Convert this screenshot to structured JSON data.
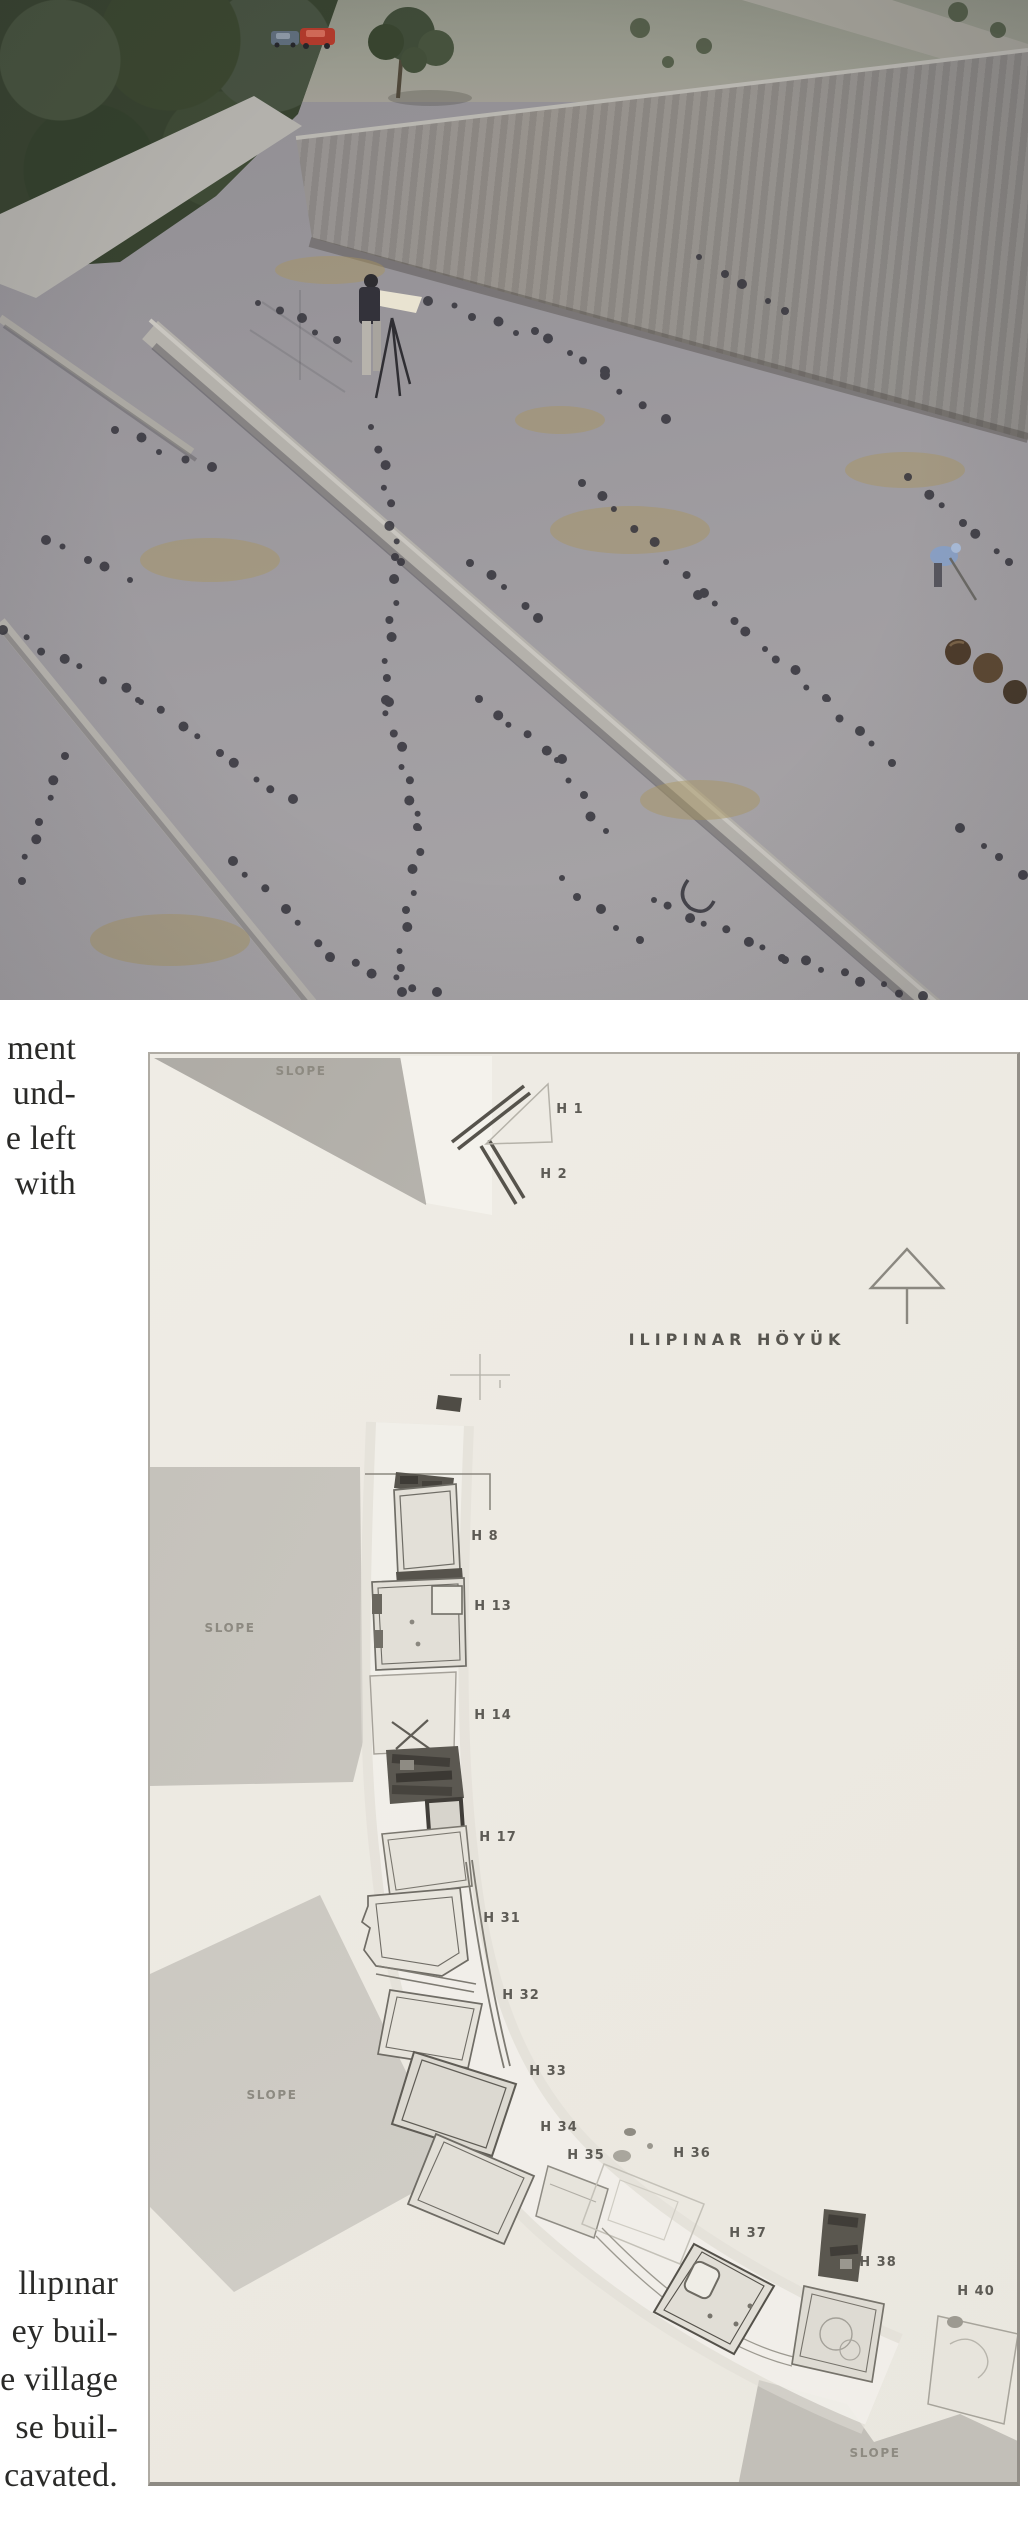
{
  "page": {
    "width": 1028,
    "height": 2546,
    "background": "#ffffff"
  },
  "captions": {
    "top_fragment_lines": [
      "ment",
      "und-",
      "e left",
      "with"
    ],
    "bottom_fragment_lines": [
      "llıpınar",
      "ey buil-",
      "e village",
      "se buil-",
      "cavated."
    ]
  },
  "photo": {
    "alt": "Excavation at Ilıpınar: surveyor with plane table on excavated surface marked by rows of dark postholes; earthen section wall, dirt road and trees above, parked cars, worker in blue, pottery vessels at right"
  },
  "plan": {
    "site_title": "ILIPINAR HÖYÜK",
    "slope_labels": [
      {
        "text": "SLOPE",
        "cx": 151,
        "cy": 18
      },
      {
        "text": "SLOPE",
        "cx": 80,
        "cy": 575
      },
      {
        "text": "SLOPE",
        "cx": 122,
        "cy": 1042
      },
      {
        "text": "SLOPE",
        "cx": 725,
        "cy": 1400
      }
    ],
    "house_labels": [
      {
        "text": "H 1",
        "cx": 420,
        "cy": 56
      },
      {
        "text": "H 2",
        "cx": 404,
        "cy": 121
      },
      {
        "text": "H 8",
        "cx": 335,
        "cy": 483
      },
      {
        "text": "H 13",
        "cx": 343,
        "cy": 553
      },
      {
        "text": "H 14",
        "cx": 343,
        "cy": 662
      },
      {
        "text": "H 17",
        "cx": 348,
        "cy": 784
      },
      {
        "text": "H 31",
        "cx": 352,
        "cy": 865
      },
      {
        "text": "H 32",
        "cx": 371,
        "cy": 942
      },
      {
        "text": "H 33",
        "cx": 398,
        "cy": 1018
      },
      {
        "text": "H 34",
        "cx": 409,
        "cy": 1074
      },
      {
        "text": "H 35",
        "cx": 436,
        "cy": 1102
      },
      {
        "text": "H 36",
        "cx": 542,
        "cy": 1100
      },
      {
        "text": "H 37",
        "cx": 598,
        "cy": 1180
      },
      {
        "text": "H 38",
        "cx": 728,
        "cy": 1209
      },
      {
        "text": "H 40",
        "cx": 826,
        "cy": 1238
      }
    ]
  },
  "colors": {
    "plan_bg": "#ece9e1",
    "slope_fill": "#c3c0b9",
    "house_label": "#5d5b55",
    "slope_label": "#8d8a81",
    "title": "#57554f",
    "caption": "#2a2a28",
    "posthole": "#35343c",
    "red_car": "#b23a2c",
    "blue_worker": "#8aa0c4"
  }
}
